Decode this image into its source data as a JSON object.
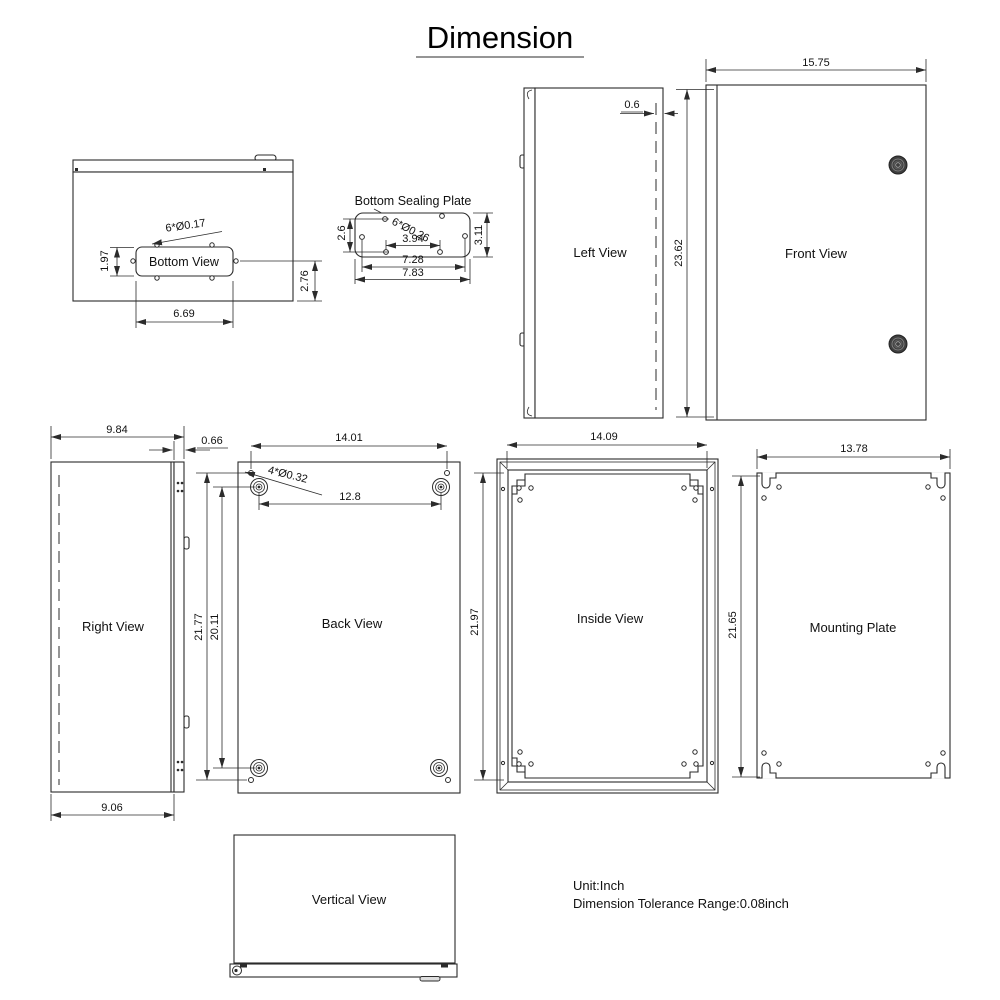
{
  "title": "Dimension",
  "colors": {
    "line": "#2b2b2b",
    "background": "#ffffff",
    "lock_fill": "#3f3f3f"
  },
  "views": {
    "bottom_view": {
      "label": "Bottom View",
      "dims": {
        "holes": "6*Ø0.17",
        "cutout_height": "1.97",
        "side_offset": "2.76",
        "cutout_width": "6.69"
      }
    },
    "bottom_sealing_plate": {
      "label": "Bottom Sealing Plate",
      "dims": {
        "holes": "6*Ø0.26",
        "hole_row_gap": "2.6",
        "inner_hole_span": "3.94",
        "plate_height": "3.11",
        "side_hole_span": "7.28",
        "plate_width": "7.83"
      }
    },
    "left_view": {
      "label": "Left View",
      "dims": {
        "door_edge": "0.6"
      }
    },
    "front_view": {
      "label": "Front View",
      "dims": {
        "width": "15.75",
        "height": "23.62"
      }
    },
    "right_view": {
      "label": "Right View",
      "dims": {
        "depth": "9.84",
        "flange": "0.66",
        "body_depth": "9.06"
      }
    },
    "back_view": {
      "label": "Back View",
      "dims": {
        "width": "14.01",
        "holes": "4*Ø0.32",
        "bracket_span": "12.8",
        "hole_height_span": "21.77",
        "bracket_height_span": "20.11"
      }
    },
    "inside_view": {
      "label": "Inside View",
      "dims": {
        "width": "14.09",
        "height": "21.97"
      }
    },
    "mounting_plate": {
      "label": "Mounting Plate",
      "dims": {
        "width": "13.78",
        "height": "21.65"
      }
    },
    "vertical_view": {
      "label": "Vertical View"
    }
  },
  "notes": {
    "unit": "Unit:Inch",
    "tolerance": "Dimension Tolerance Range:0.08inch"
  }
}
